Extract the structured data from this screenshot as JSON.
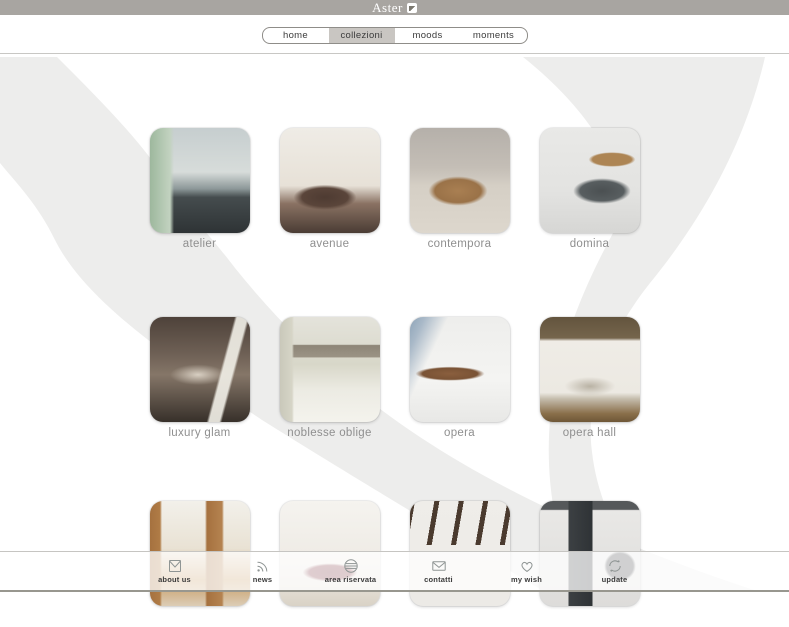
{
  "header": {
    "brand": "Aster"
  },
  "nav": {
    "items": [
      {
        "id": "home",
        "label": "home",
        "active": false
      },
      {
        "id": "collezioni",
        "label": "collezioni",
        "active": true
      },
      {
        "id": "moods",
        "label": "moods",
        "active": false
      },
      {
        "id": "moments",
        "label": "moments",
        "active": false
      }
    ]
  },
  "collections": {
    "rows": [
      [
        {
          "id": "atelier",
          "label": "atelier",
          "art": "atelier"
        },
        {
          "id": "avenue",
          "label": "avenue",
          "art": "avenue"
        },
        {
          "id": "contempora",
          "label": "contempora",
          "art": "contempora"
        },
        {
          "id": "domina",
          "label": "domina",
          "art": "domina"
        }
      ],
      [
        {
          "id": "luxury-glam",
          "label": "luxury glam",
          "art": "luxury-glam"
        },
        {
          "id": "noblesse-oblige",
          "label": "noblesse oblige",
          "art": "noblesse-oblige"
        },
        {
          "id": "opera",
          "label": "opera",
          "art": "opera"
        },
        {
          "id": "opera-hall",
          "label": "opera hall",
          "art": "opera-hall"
        }
      ],
      [
        {
          "id": "row3-1",
          "label": "",
          "art": "sinfonia"
        },
        {
          "id": "row3-2",
          "label": "",
          "art": "tray"
        },
        {
          "id": "row3-3",
          "label": "",
          "art": "beams"
        },
        {
          "id": "row3-4",
          "label": "",
          "art": "dark-modern"
        }
      ]
    ]
  },
  "footer": {
    "items": [
      {
        "id": "about-us",
        "label": "about us",
        "icon": "envelope-square-icon"
      },
      {
        "id": "news",
        "label": "news",
        "icon": "rss-icon"
      },
      {
        "id": "area-riservata",
        "label": "area riservata",
        "icon": "lines-circle-icon"
      },
      {
        "id": "contatti",
        "label": "contatti",
        "icon": "mail-icon"
      },
      {
        "id": "my-wish",
        "label": "my wish",
        "icon": "heart-icon"
      },
      {
        "id": "update",
        "label": "update",
        "icon": "refresh-icon"
      }
    ]
  },
  "colors": {
    "topbar": "#a8a5a1",
    "nav_active_bg": "#c9c6c2",
    "background_accent": "#ededec",
    "tile_label": "#8f8f8f"
  }
}
